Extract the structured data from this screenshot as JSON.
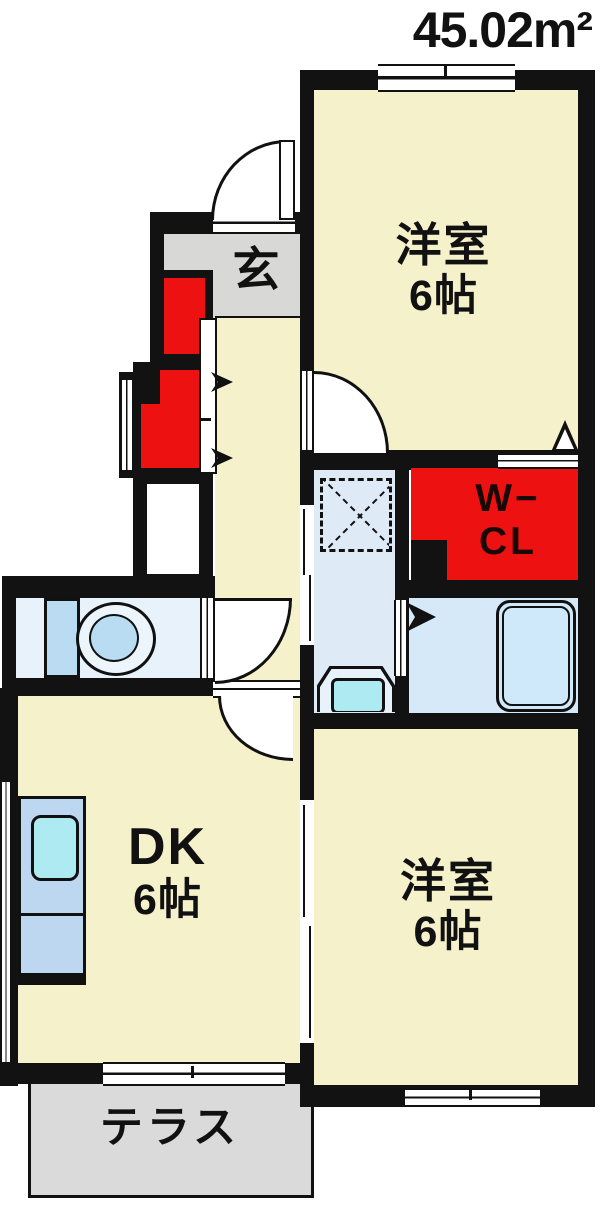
{
  "title": "45.02m²",
  "labels": {
    "room_top": {
      "name": "洋室",
      "size": "6帖"
    },
    "room_bottom": {
      "name": "洋室",
      "size": "6帖"
    },
    "dk": {
      "name": "DK",
      "size": "6帖"
    },
    "entrance": "玄",
    "wcl_line1": "W−",
    "wcl_line2": "CL",
    "terrace": "テラス"
  },
  "colors": {
    "wall": "#121212",
    "room-cream": "#f5f1cb",
    "entry-gray": "#d8d8d6",
    "terrace-gray": "#dadada",
    "wet-blue": "#dfeaf7",
    "bath-blue": "#d5e9f8",
    "fixture-blue": "#b9dcf2",
    "sink-cyan": "#aeeaf2",
    "counter-blue": "#bdd7f1",
    "accent-red": "#ee1111"
  },
  "icons": {
    "bathtub": "rounded-rect-outline",
    "toilet": "tank-and-bowl",
    "washbasin": "trapezoid-sink",
    "kitchen-counter": "counter-with-sink",
    "washing-machine-area": "dashed-square-x",
    "door-swing": "quarter-arc",
    "sliding-door": "double-line-band",
    "window": "triple-line-band",
    "vent": "triangle-marker",
    "closet-door-arrow": "right-flag"
  }
}
